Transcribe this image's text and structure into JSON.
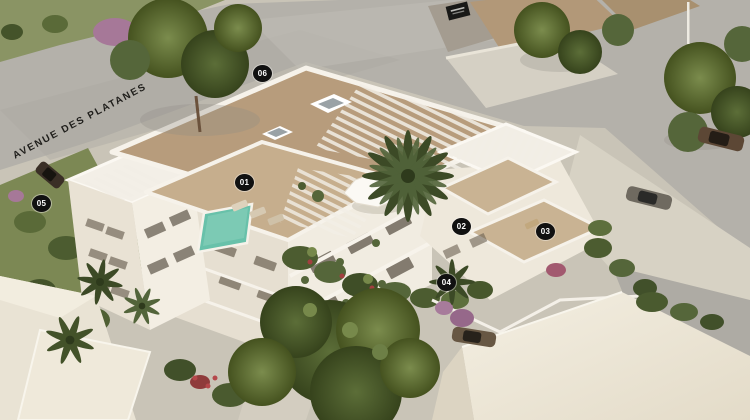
{
  "street_label": "AVENUE DES PLATANES",
  "badges": [
    {
      "label": "01"
    },
    {
      "label": "02"
    },
    {
      "label": "03"
    },
    {
      "label": "04"
    },
    {
      "label": "05"
    },
    {
      "label": "06"
    }
  ],
  "colors": {
    "badge_bg": "#111111",
    "badge_text": "#ffffff",
    "roof_tan": "#b79c7c",
    "terrace_floor": "#c6ae8d",
    "wall_white": "#f1ece1",
    "pool": "#68c1aa",
    "road_gray": "#b4b1aa",
    "pavement": "#d7d2c4",
    "grass": "#7c8854",
    "tree_green": "#4c5c30",
    "street_text": "#1f1e1b"
  }
}
